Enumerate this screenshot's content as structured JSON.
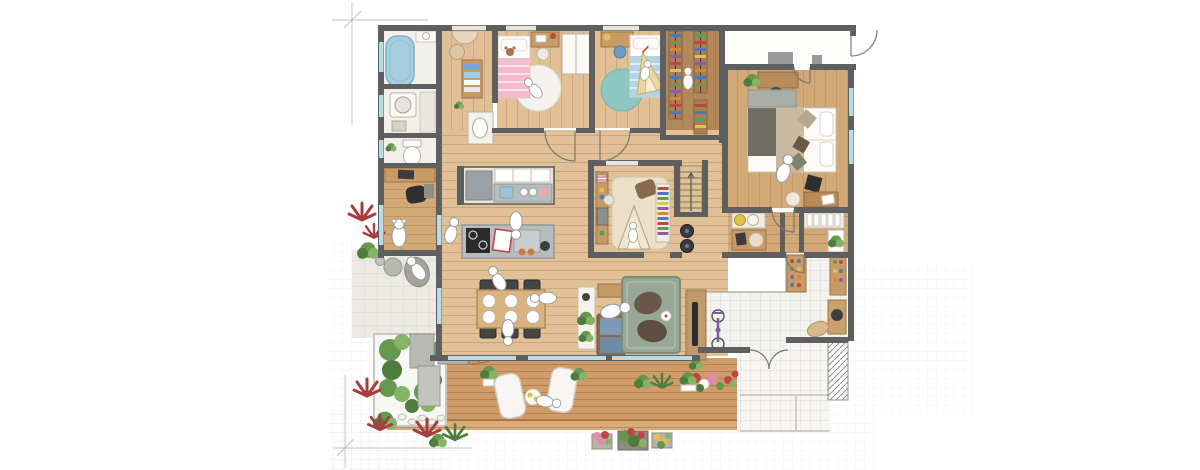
{
  "scene": {
    "kind": "hand-drawn-watercolor-floor-plan",
    "text_visible": false,
    "rooms": [
      {
        "name": "bathroom",
        "features": [
          "bathtub",
          "small-sink"
        ]
      },
      {
        "name": "laundry-room",
        "features": [
          "washing-machine",
          "counter"
        ]
      },
      {
        "name": "toilet-room",
        "features": [
          "toilet",
          "plant"
        ]
      },
      {
        "name": "study-nook",
        "features": [
          "desk",
          "black-chair",
          "dog-figure"
        ]
      },
      {
        "name": "washroom-corridor",
        "features": [
          "vanity-basin",
          "towel-shelf",
          "stool"
        ]
      },
      {
        "name": "kids-bedroom-pink",
        "features": [
          "pink-bed",
          "round-white-rug",
          "desk",
          "chair"
        ]
      },
      {
        "name": "kids-bedroom-blue",
        "features": [
          "blue-bed",
          "round-teal-rug",
          "desk",
          "play-tent",
          "wardrobe"
        ]
      },
      {
        "name": "walk-in-closet",
        "features": [
          "clothes-racks-colorful"
        ]
      },
      {
        "name": "entrance-hall-top",
        "features": [
          "door-swing"
        ]
      },
      {
        "name": "master-bedroom",
        "features": [
          "double-bed",
          "headboard",
          "cushions",
          "desk-with-plant",
          "desk-with-chair",
          "stool"
        ]
      },
      {
        "name": "kitchen",
        "features": [
          "back-counter",
          "fridge",
          "sink",
          "island",
          "cooktop",
          "cutting-board"
        ]
      },
      {
        "name": "dining-area",
        "features": [
          "table-6-plates",
          "6-dark-chairs"
        ]
      },
      {
        "name": "living-area",
        "features": [
          "plant-shelf",
          "sofa-blue-cushions",
          "green-rug",
          "2-bean-bags",
          "tv-panel"
        ]
      },
      {
        "name": "kids-playroom",
        "features": [
          "beige-rug",
          "teepee",
          "bookshelf",
          "toy-desk"
        ]
      },
      {
        "name": "staircase",
        "features": [
          "steps",
          "speakers-below"
        ]
      },
      {
        "name": "wash-corridor-right",
        "features": [
          "twin-basins",
          "work-desk",
          "slat-shelf",
          "plant-frame"
        ]
      },
      {
        "name": "genkan-entrance",
        "features": [
          "shoe-cabinets",
          "bench",
          "doormat",
          "bicycle",
          "flower-pots"
        ]
      },
      {
        "name": "porch",
        "features": [
          "tiled-steps",
          "hatched-strip"
        ]
      },
      {
        "name": "patio",
        "features": [
          "stepping-stone",
          "bean-bag-person",
          "red-plants"
        ]
      },
      {
        "name": "courtyard-garden",
        "features": [
          "green-shrubs",
          "stone-path",
          "pebbles",
          "bbq-grill",
          "crate"
        ]
      },
      {
        "name": "wood-deck",
        "features": [
          "2-loungers",
          "round-table-drinks",
          "potted-plants",
          "flower-planters"
        ]
      }
    ],
    "figure_count": 12
  },
  "palette": {
    "paper": "#ffffff",
    "gridline": "#ccd8de",
    "pencil": "#b9c0c6",
    "wall": "#5f5f5f",
    "wallLight": "#9a9a9a",
    "window": "#bcd9e6",
    "windowWhite": "#eae5da",
    "wood1": "#e0c094",
    "wood2": "#d2a877",
    "wood3": "#b2885b",
    "deck": "#cf9c69",
    "tileWhite": "#f3f2ee",
    "patio": "#eceae5",
    "porch": "#f6f5f1",
    "counter": "#b7bcbe",
    "fridge": "#9aa0a3",
    "cooktop": "#2b2b2b",
    "steel": "#c9cdcf",
    "tub": "#a5cfdc",
    "tubStroke": "#7fb3c4",
    "cream": "#f5f2ea",
    "tan": "#c89a66",
    "tableTan": "#d9b37f",
    "chairDark": "#454545",
    "pink": "#f3bccd",
    "blueBed": "#b5d3e7",
    "tealRug": "#8ec7c1",
    "whiteRug": "#f4f2ed",
    "livingRug": "#97a695",
    "livingRugEdge": "#7d8d7c",
    "kidsRug": "#eadfc8",
    "beanbag1": "#6b584a",
    "beanbag2": "#5f4d40",
    "sofaBlue": "#7e99b4",
    "sofaBlue2": "#6f8aa6",
    "green1": "#67984f",
    "green2": "#4e7d3e",
    "green3": "#86b368",
    "redPlant": "#a83d3d",
    "stone": "#b5b5af",
    "accentRed": "#c24545",
    "accentBlue": "#4e79b8",
    "accentGreen": "#58a05a",
    "accentOrange": "#d98436",
    "accentPurple": "#8a5fa8",
    "accentYellow": "#e0c050",
    "flowerPink": "#e08bb0",
    "figStroke": "#9b9b9b",
    "olive": "#6e6e62",
    "blanketTan": "#cbb9a2",
    "headboard": "#a9aeaa",
    "bikePurple": "#7a5fa0",
    "hatch": "#8d8d8d"
  }
}
